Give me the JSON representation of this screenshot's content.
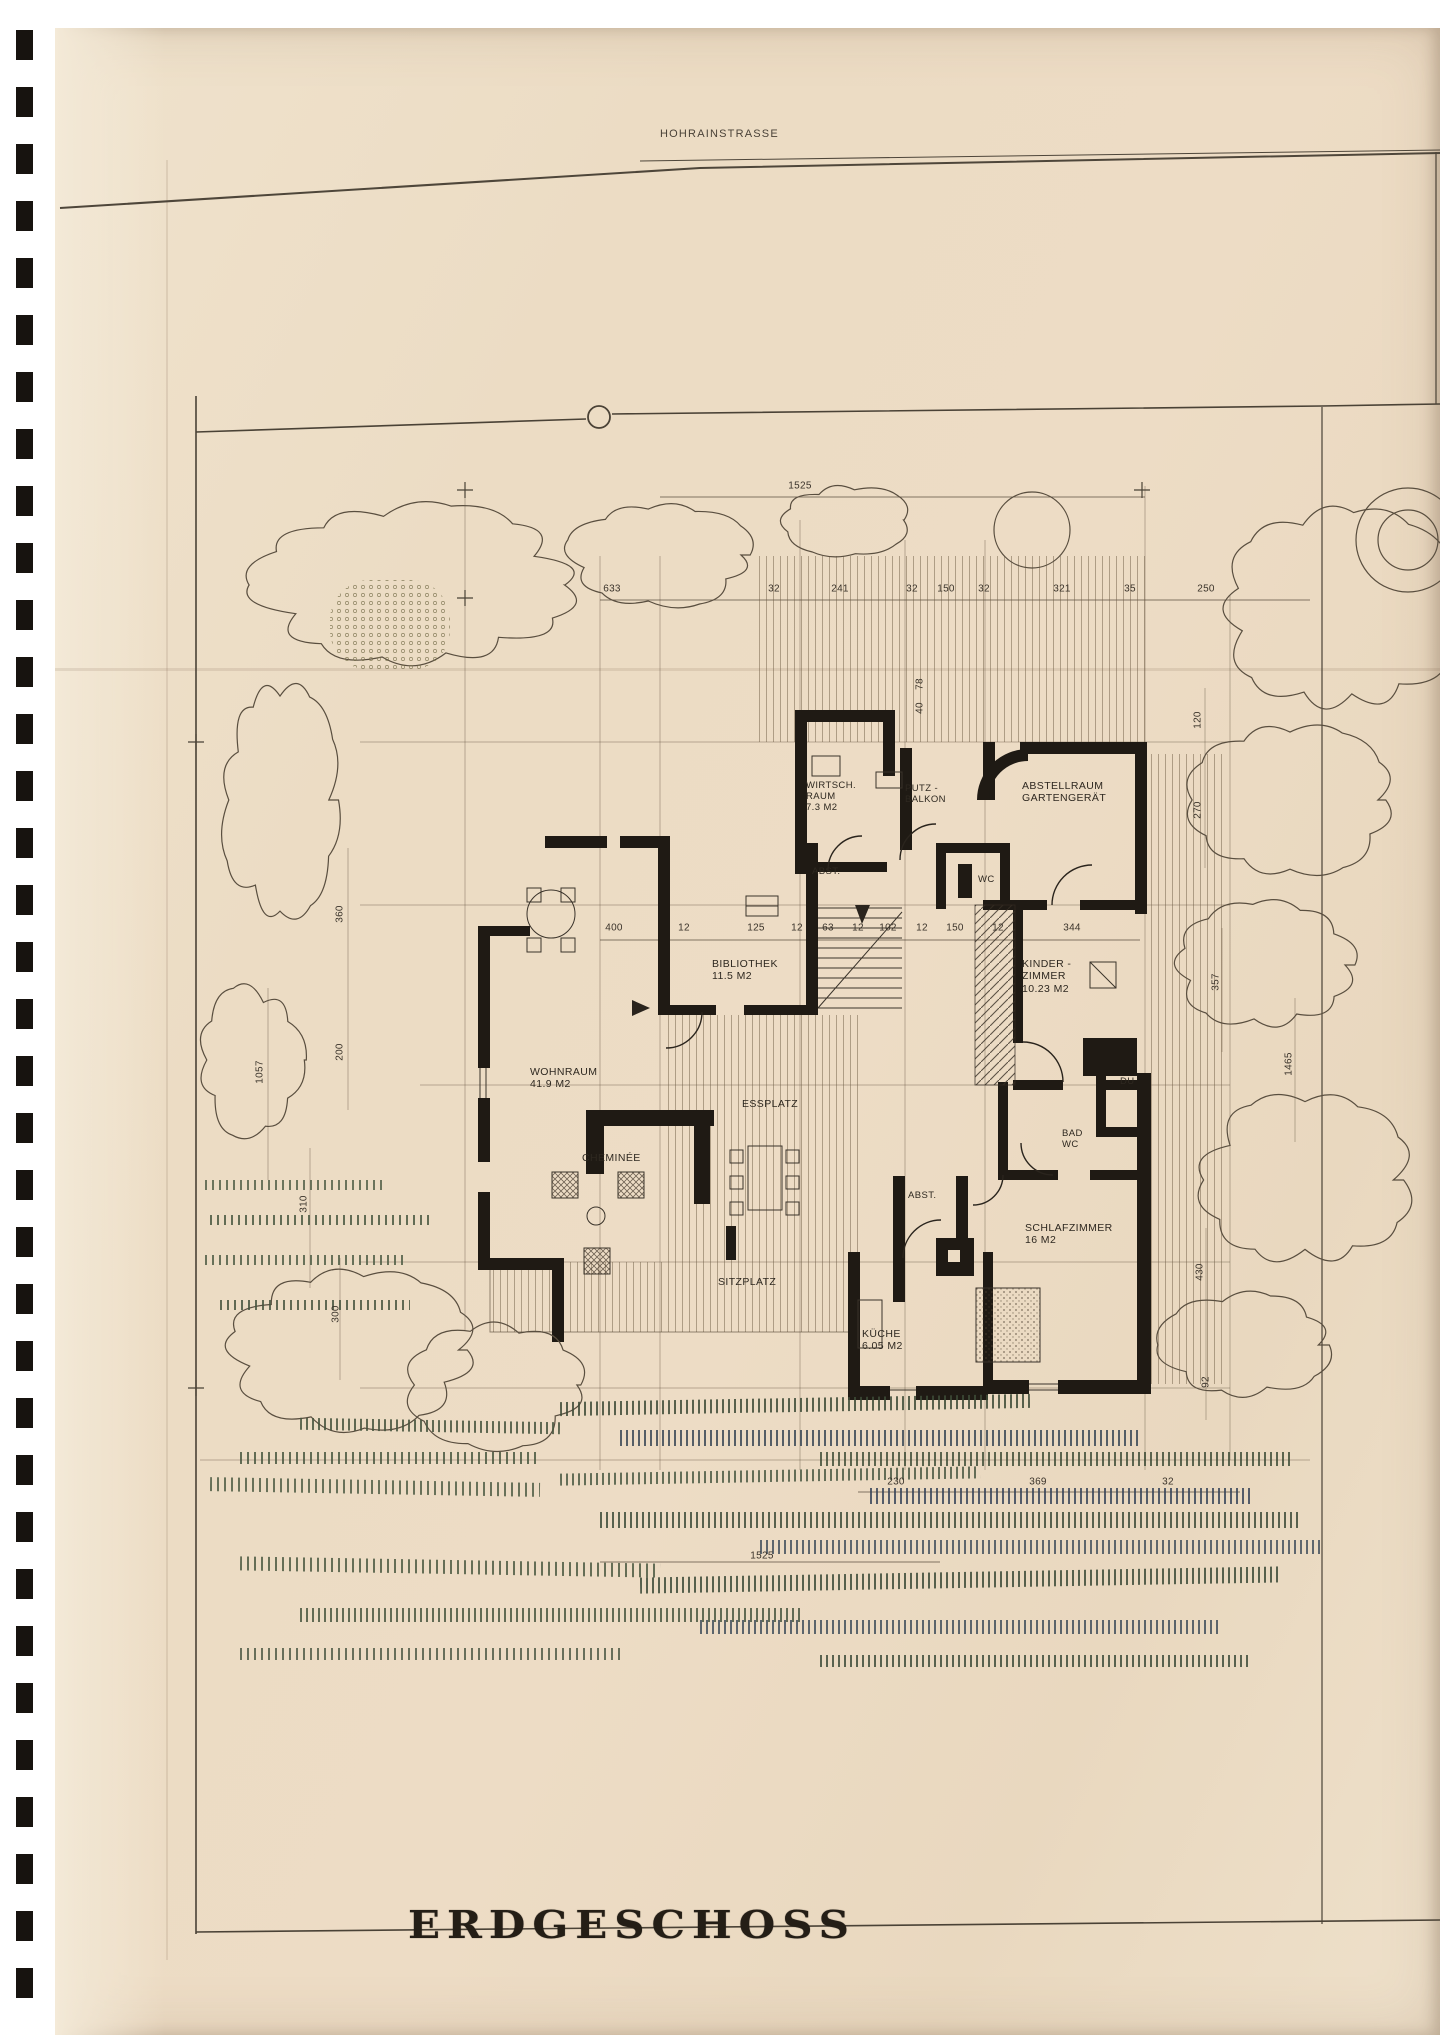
{
  "scan": {
    "street_label": "HOHRAINSTRASSE",
    "plan_title": "ERDGESCHOSS"
  },
  "rooms": {
    "wirtschraum": {
      "label": "WIRTSCH.\nRAUM\n7.3 M2"
    },
    "putz_balkon": {
      "label": "PUTZ -\nBALKON"
    },
    "abstellraum": {
      "label": "ABSTELLRAUM\nGARTENGERÄT"
    },
    "abst_upper": {
      "label": "ABST."
    },
    "wc_upper": {
      "label": "WC"
    },
    "bibliothek": {
      "label": "BIBLIOTHEK\n11.5 M2"
    },
    "kinderzimmer": {
      "label": "KINDER -\nZIMMER\n10.23 M2"
    },
    "wohnraum": {
      "label": "WOHNRAUM\n41.9 M2"
    },
    "essplatz": {
      "label": "ESSPLATZ"
    },
    "cheminee": {
      "label": "CHEMINÉE"
    },
    "du": {
      "label": "DU"
    },
    "bad": {
      "label": "BAD\nWC"
    },
    "abst_lower": {
      "label": "ABST."
    },
    "schlafzimmer": {
      "label": "SCHLAFZIMMER\n16 M2"
    },
    "sitzplatz": {
      "label": "SITZPLATZ"
    },
    "kueche": {
      "label": "KÜCHE\n6.05 M2"
    }
  },
  "dimensions": {
    "top_total": "1525",
    "top_row": [
      "633",
      "32",
      "241",
      "32",
      "150",
      "32",
      "321",
      "35",
      "250"
    ],
    "mid_row": [
      "400",
      "12",
      "125",
      "12",
      "63",
      "12",
      "102",
      "12",
      "150",
      "12",
      "344"
    ],
    "balcony_pair": [
      "78",
      "40"
    ],
    "right_side": [
      "120",
      "270",
      "357",
      "1465",
      "430",
      "92"
    ],
    "left_side": [
      "360",
      "200",
      "1057",
      "310",
      "300"
    ],
    "bottom_row": [
      "230",
      "369",
      "32"
    ],
    "bottom_total": "1525"
  },
  "colors": {
    "paper": "#ecdcc4",
    "ink": "#2c261e",
    "wall": "#1f1a14",
    "vegetation_green": "#46543d",
    "vegetation_blue": "#3a4858"
  }
}
